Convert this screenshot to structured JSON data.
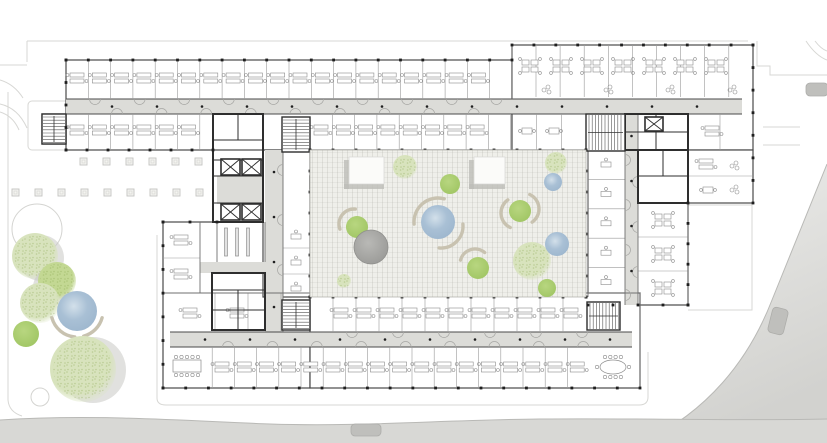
{
  "title": "office-building-ground-floor-plan",
  "palette": {
    "bg": "#ffffff",
    "faint": "#d7d7d4",
    "plinth": "#d0d0cd",
    "wall": "#4a4a4a",
    "wallDark": "#2e2e2e",
    "thin": "#9a9a9a",
    "corridor": "#dcdcd8",
    "court": "#efefea",
    "courtEdge": "#b5b5b0",
    "road": "#d8d8d5",
    "roadEdge": "#b9b9b6",
    "plazaTop": "#ededeb",
    "plazaBot": "#d2d2cf",
    "car": "#bfbfbc",
    "carEdge": "#adadaa",
    "tick": "#1f1f1f",
    "deskStroke": "#8c8c8c",
    "bench": "#c8c2b0",
    "pavilion": "#fbfbf9",
    "pavShadow": "#bdbdb8",
    "treeSolidA": "#b8d680",
    "treeSolidB": "#a2c766",
    "treeLight": "#d8e3bd",
    "treeMid": "#c3d893",
    "waterA": "#d3e0ea",
    "waterB": "#a9c0d5",
    "waterC": "#9fb8cf",
    "greyA": "#b9b9b6",
    "greyB": "#9d9d9a",
    "shadow": "#c9c9c4"
  },
  "site": {
    "faintPaths": [
      "M27,41 H748",
      "M27,41 V62",
      "M0,65 H27",
      "M0,80 Q14,84 23,98",
      "M0,104 Q18,108 27,128",
      "M0,112 Q13,116 19,130",
      "M8,92 V400 Q9,412 22,416",
      "M757,41 V66 H770 V75 H827",
      "M763,127 H800",
      "M763,145 H800",
      "M688,205 H752 V310 H688",
      "M806,41 Q816,56 827,60",
      "M815,41 Q821,49 827,51",
      "M157,235 V398 Q157,405 166,405 H639 Q648,405 648,397 V352"
    ],
    "stairCourt": {
      "x": 28,
      "y": 101,
      "w": 52,
      "h": 49
    },
    "road": {
      "fill": "M0,420 C90,414 170,420 270,424 C360,427 440,420 540,419 C640,418 740,421 827,419 L827,443 L0,443 Z",
      "edge": "M0,420 C90,414 170,420 270,424 C360,427 440,420 540,419 C640,418 740,421 827,419"
    },
    "plaza": {
      "fill": "M827,164 L772,300 C748,362 706,412 645,441 L827,443 Z",
      "edge": "M827,164 L772,300 C748,362 706,412 645,441"
    },
    "cars": [
      {
        "x": 351,
        "y": 424,
        "w": 30,
        "h": 12,
        "angle": 0
      },
      {
        "x": 770,
        "y": 308,
        "w": 16,
        "h": 26,
        "angle": 14
      },
      {
        "x": 806,
        "y": 83,
        "w": 22,
        "h": 13,
        "angle": 0
      }
    ],
    "pergola": {
      "size": 7,
      "rows": [
        {
          "y": 158,
          "x0": 80,
          "n": 6,
          "step": 23
        },
        {
          "y": 189,
          "x0": 12,
          "n": 9,
          "step": 23
        }
      ]
    }
  },
  "building": {
    "wings": [
      {
        "name": "north-wing",
        "x": 66,
        "y": 60,
        "w": 446,
        "h": 90
      },
      {
        "name": "northeast-wing",
        "x": 512,
        "y": 45,
        "w": 241,
        "h": 105
      },
      {
        "name": "east-annex",
        "x": 688,
        "y": 150,
        "w": 65,
        "h": 53
      },
      {
        "name": "east-wing",
        "x": 588,
        "y": 150,
        "w": 100,
        "h": 155
      },
      {
        "name": "west-block",
        "x": 163,
        "y": 222,
        "w": 147,
        "h": 166
      },
      {
        "name": "south-wing",
        "x": 310,
        "y": 293,
        "w": 330,
        "h": 95
      },
      {
        "name": "west-link",
        "x": 263,
        "y": 150,
        "w": 47,
        "h": 147
      },
      {
        "name": "stair-tower",
        "x": 42,
        "y": 114,
        "w": 24,
        "h": 30
      }
    ],
    "corridors": [
      {
        "x": 66,
        "y": 99,
        "w": 676,
        "h": 15
      },
      {
        "x": 625,
        "y": 114,
        "w": 13,
        "h": 191
      },
      {
        "x": 170,
        "y": 332,
        "w": 462,
        "h": 15
      },
      {
        "x": 265,
        "y": 150,
        "w": 18,
        "h": 182
      },
      {
        "x": 217,
        "y": 176,
        "w": 46,
        "h": 28
      },
      {
        "x": 200,
        "y": 262,
        "w": 83,
        "h": 11
      }
    ],
    "partitionsV": [
      {
        "x0": 88.3,
        "x1": 511,
        "step": 22.3,
        "y0": 60,
        "y1": 99
      },
      {
        "x0": 88.3,
        "x1": 212,
        "step": 22.3,
        "y0": 114,
        "y1": 150
      },
      {
        "x0": 332.3,
        "x1": 511,
        "step": 22.3,
        "y0": 114,
        "y1": 150
      },
      {
        "x0": 536,
        "x1": 752,
        "step": 24.1,
        "y0": 45,
        "y1": 97
      },
      {
        "x0": 536.7,
        "x1": 585,
        "step": 24.7,
        "y0": 114,
        "y1": 150
      },
      {
        "x0": 720,
        "x1": 752,
        "step": 33,
        "y0": 114,
        "y1": 150
      },
      {
        "x0": 333,
        "x1": 585,
        "step": 23,
        "y0": 297,
        "y1": 332
      },
      {
        "x0": 212.2,
        "x1": 589,
        "step": 22.2,
        "y0": 347,
        "y1": 388
      },
      {
        "x0": 215,
        "x1": 281,
        "step": 33,
        "y0": 293,
        "y1": 332
      }
    ],
    "partitionsH": [
      {
        "y0": 179.4,
        "y1": 296,
        "step": 29.4,
        "x0": 588,
        "x1": 625
      },
      {
        "y0": 237,
        "y1": 304,
        "step": 34,
        "x0": 638,
        "x1": 688
      },
      {
        "y0": 176,
        "y1": 203,
        "step": 100,
        "x0": 688,
        "x1": 753
      },
      {
        "y0": 258,
        "y1": 292,
        "step": 40,
        "x0": 163,
        "x1": 200
      },
      {
        "y0": 248,
        "y1": 300,
        "step": 26,
        "x0": 283,
        "x1": 310
      }
    ],
    "walls": [
      [
        200,
        222,
        200,
        293
      ],
      [
        217,
        222,
        217,
        262
      ],
      [
        265,
        222,
        265,
        262
      ],
      [
        283,
        150,
        283,
        332
      ],
      [
        638,
        114,
        638,
        150
      ],
      [
        625,
        150,
        625,
        305
      ],
      [
        638,
        203,
        638,
        305
      ],
      [
        512,
        45,
        512,
        99
      ],
      [
        586,
        114,
        586,
        150
      ],
      [
        163,
        293,
        310,
        293
      ],
      [
        586,
        293,
        640,
        293
      ],
      [
        640,
        293,
        640,
        388
      ],
      [
        688,
        150,
        688,
        305
      ],
      [
        588,
        150,
        588,
        297
      ]
    ],
    "cores": [
      {
        "x": 213,
        "y": 114,
        "w": 50,
        "h": 108
      },
      {
        "x": 625,
        "y": 114,
        "w": 63,
        "h": 36
      },
      {
        "x": 638,
        "y": 150,
        "w": 50,
        "h": 53
      },
      {
        "x": 212,
        "y": 273,
        "w": 53,
        "h": 57
      }
    ],
    "coreLines": [
      [
        213,
        140,
        263,
        140
      ],
      [
        213,
        160,
        263,
        160
      ],
      [
        213,
        176,
        263,
        176
      ],
      [
        213,
        203,
        263,
        203
      ],
      [
        238,
        114,
        238,
        140
      ],
      [
        656,
        114,
        656,
        150
      ],
      [
        625,
        132,
        688,
        132
      ],
      [
        663,
        150,
        663,
        176
      ],
      [
        638,
        176,
        688,
        176
      ],
      [
        212,
        290,
        265,
        290
      ],
      [
        238,
        290,
        238,
        330
      ],
      [
        212,
        310,
        265,
        310
      ]
    ],
    "stairs": [
      {
        "x": 282,
        "y": 117,
        "w": 28,
        "h": 35
      },
      {
        "x": 586,
        "y": 114,
        "w": 39,
        "h": 37
      },
      {
        "x": 282,
        "y": 300,
        "w": 28,
        "h": 30
      },
      {
        "x": 587,
        "y": 302,
        "w": 33,
        "h": 28
      },
      {
        "x": 42,
        "y": 114,
        "w": 24,
        "h": 30
      },
      {
        "x": 310,
        "y": 176,
        "w": 15,
        "h": 13
      }
    ],
    "elevators": [
      {
        "x": 221,
        "y": 159,
        "w": 19,
        "h": 16
      },
      {
        "x": 242,
        "y": 159,
        "w": 19,
        "h": 16
      },
      {
        "x": 221,
        "y": 204,
        "w": 19,
        "h": 16
      },
      {
        "x": 242,
        "y": 204,
        "w": 19,
        "h": 16
      },
      {
        "x": 645,
        "y": 117,
        "w": 18,
        "h": 14
      }
    ],
    "shelves": {
      "xs": [
        226,
        237,
        248
      ],
      "y": 228,
      "h": 28
    },
    "ticks": [
      {
        "x1": 66,
        "y1": 60,
        "x2": 512,
        "y2": 60
      },
      {
        "x1": 512,
        "y1": 45,
        "x2": 753,
        "y2": 45
      },
      {
        "x1": 66,
        "y1": 60,
        "x2": 66,
        "y2": 150
      },
      {
        "x1": 753,
        "y1": 45,
        "x2": 753,
        "y2": 203
      },
      {
        "x1": 66,
        "y1": 150,
        "x2": 213,
        "y2": 150
      },
      {
        "x1": 310,
        "y1": 150,
        "x2": 586,
        "y2": 150
      },
      {
        "x1": 310,
        "y1": 297,
        "x2": 586,
        "y2": 297
      },
      {
        "x1": 310,
        "y1": 150,
        "x2": 310,
        "y2": 297
      },
      {
        "x1": 586,
        "y1": 150,
        "x2": 586,
        "y2": 297
      },
      {
        "x1": 163,
        "y1": 222,
        "x2": 163,
        "y2": 388
      },
      {
        "x1": 163,
        "y1": 222,
        "x2": 217,
        "y2": 222
      },
      {
        "x1": 163,
        "y1": 388,
        "x2": 640,
        "y2": 388
      },
      {
        "x1": 688,
        "y1": 203,
        "x2": 688,
        "y2": 305
      },
      {
        "x1": 588,
        "y1": 305,
        "x2": 688,
        "y2": 305
      }
    ],
    "dotsH": [
      {
        "y": 106.5,
        "x0": 112,
        "step": 45,
        "n": 14
      },
      {
        "y": 339.5,
        "x0": 205,
        "step": 45,
        "n": 10
      }
    ],
    "dotsV": [
      {
        "x": 631.5,
        "y0": 136,
        "step": 45,
        "n": 4
      },
      {
        "x": 274,
        "y0": 172,
        "step": 45,
        "n": 4
      }
    ],
    "doorsH": [
      {
        "y": 99,
        "x0": 95,
        "step": 44.6,
        "n": 10,
        "sweep": 0
      },
      {
        "y": 114,
        "x0": 117,
        "step": 44.6,
        "n": 9,
        "sweep": 1
      },
      {
        "y": 332,
        "x0": 352,
        "step": 46,
        "n": 6,
        "sweep": 0
      },
      {
        "y": 347,
        "x0": 228,
        "step": 44.4,
        "n": 9,
        "sweep": 1
      }
    ],
    "doorsV": [
      {
        "x": 625,
        "y0": 160,
        "step": 45,
        "n": 4,
        "sweep": 1
      },
      {
        "x": 638,
        "y0": 182,
        "step": 45,
        "n": 3,
        "sweep": 0
      },
      {
        "x": 283,
        "y0": 170,
        "step": 50,
        "n": 3,
        "sweep": 0
      }
    ],
    "bands": [
      {
        "g": "pairH",
        "x0": 77,
        "step": 22.3,
        "n": 19,
        "y": 78
      },
      {
        "g": "pairH",
        "x0": 77,
        "step": 22.3,
        "n": 6,
        "y": 130
      },
      {
        "g": "pairH",
        "x0": 321,
        "step": 22.3,
        "n": 8,
        "y": 130
      },
      {
        "g": "quad",
        "x0": 530,
        "step": 31,
        "n": 7,
        "y": 66
      },
      {
        "g": "sofa",
        "x0": 547,
        "step": 62,
        "n": 4,
        "y": 90
      },
      {
        "g": "miniTable",
        "x0": 527,
        "step": 27,
        "n": 2,
        "y": 131
      },
      {
        "g": "pairH",
        "x0": 712,
        "step": 26,
        "n": 1,
        "y": 131
      },
      {
        "g": "pairH",
        "x0": 341,
        "step": 23,
        "n": 11,
        "y": 313
      },
      {
        "g": "pairH",
        "x0": 222,
        "step": 22.2,
        "n": 17,
        "y": 367
      },
      {
        "g": "pairH",
        "x0": 190,
        "step": 47,
        "n": 2,
        "y": 313
      }
    ],
    "vbands": [
      {
        "g": "singleH",
        "y0": 164,
        "step": 29.4,
        "n": 5,
        "x": 606
      },
      {
        "g": "quad",
        "y0": 220,
        "step": 34,
        "n": 3,
        "x": 663
      },
      {
        "g": "singleH",
        "y0": 236,
        "step": 26,
        "n": 3,
        "x": 296
      },
      {
        "g": "pairH",
        "y0": 240,
        "step": 34,
        "n": 2,
        "x": 181
      },
      {
        "g": "pairH",
        "y0": 164,
        "step": 26,
        "n": 1,
        "x": 706
      },
      {
        "g": "sofa",
        "y0": 166,
        "step": 24,
        "n": 2,
        "x": 735
      },
      {
        "g": "miniTable",
        "y0": 190,
        "step": 20,
        "n": 1,
        "x": 708
      }
    ],
    "meetings": [
      {
        "kind": "rect",
        "x": 187,
        "y": 366
      },
      {
        "kind": "oval",
        "x": 613,
        "y": 367
      }
    ]
  },
  "courtyard": {
    "x": 310,
    "y": 150,
    "w": 276,
    "h": 147,
    "pavilions": [
      {
        "x": 349,
        "y": 157,
        "w": 35,
        "h": 27
      },
      {
        "x": 474,
        "y": 157,
        "w": 31,
        "h": 27
      }
    ],
    "items": [
      {
        "t": "treeLight",
        "x": 405,
        "y": 167,
        "r": 12
      },
      {
        "t": "treeSolid",
        "x": 450,
        "y": 184,
        "r": 10
      },
      {
        "t": "treeLight",
        "x": 556,
        "y": 163,
        "r": 11
      },
      {
        "t": "water",
        "x": 553,
        "y": 182,
        "r": 9
      },
      {
        "t": "water",
        "x": 438,
        "y": 222,
        "r": 17
      },
      {
        "t": "arc",
        "x": 438,
        "y": 222,
        "r": 24,
        "a1": 175,
        "a2": 285
      },
      {
        "t": "arc",
        "x": 441,
        "y": 226,
        "r": 22,
        "a1": 355,
        "a2": 95
      },
      {
        "t": "treeSolid",
        "x": 520,
        "y": 211,
        "r": 11
      },
      {
        "t": "arc",
        "x": 517,
        "y": 213,
        "r": 16,
        "a1": 115,
        "a2": 235
      },
      {
        "t": "arc",
        "x": 523,
        "y": 209,
        "r": 16,
        "a1": 295,
        "a2": 55
      },
      {
        "t": "treeSolid",
        "x": 357,
        "y": 227,
        "r": 11
      },
      {
        "t": "arc",
        "x": 354,
        "y": 224,
        "r": 15,
        "a1": 160,
        "a2": 275
      },
      {
        "t": "grey",
        "x": 371,
        "y": 247,
        "r": 17
      },
      {
        "t": "treeLight",
        "x": 344,
        "y": 281,
        "r": 7
      },
      {
        "t": "treeSolid",
        "x": 478,
        "y": 268,
        "r": 11
      },
      {
        "t": "arc",
        "x": 475,
        "y": 264,
        "r": 15,
        "a1": 195,
        "a2": 310
      },
      {
        "t": "treeLight",
        "x": 532,
        "y": 261,
        "r": 19
      },
      {
        "t": "water",
        "x": 557,
        "y": 244,
        "r": 12
      },
      {
        "t": "treeSolid",
        "x": 547,
        "y": 288,
        "r": 9
      }
    ]
  },
  "landscape": {
    "items": [
      {
        "t": "outline",
        "x": 37,
        "y": 229,
        "r": 25
      },
      {
        "t": "shadow",
        "x": 41,
        "y": 258,
        "r": 23
      },
      {
        "t": "treeLight",
        "x": 35,
        "y": 256,
        "r": 23
      },
      {
        "t": "shadow",
        "x": 52,
        "y": 287,
        "r": 19
      },
      {
        "t": "treeMid",
        "x": 57,
        "y": 281,
        "r": 19
      },
      {
        "t": "treeLight",
        "x": 40,
        "y": 303,
        "r": 20
      },
      {
        "t": "water",
        "x": 77,
        "y": 311,
        "r": 20
      },
      {
        "t": "treeSolid",
        "x": 26,
        "y": 334,
        "r": 13
      },
      {
        "t": "arc",
        "x": 77,
        "y": 311,
        "r": 26,
        "a1": 95,
        "a2": 165
      },
      {
        "t": "arc",
        "x": 77,
        "y": 311,
        "r": 26,
        "a1": 15,
        "a2": 75
      },
      {
        "t": "shadow",
        "x": 93,
        "y": 370,
        "r": 33
      },
      {
        "t": "treeLight",
        "x": 83,
        "y": 369,
        "r": 33
      },
      {
        "t": "outline",
        "x": 40,
        "y": 397,
        "r": 9
      }
    ]
  }
}
